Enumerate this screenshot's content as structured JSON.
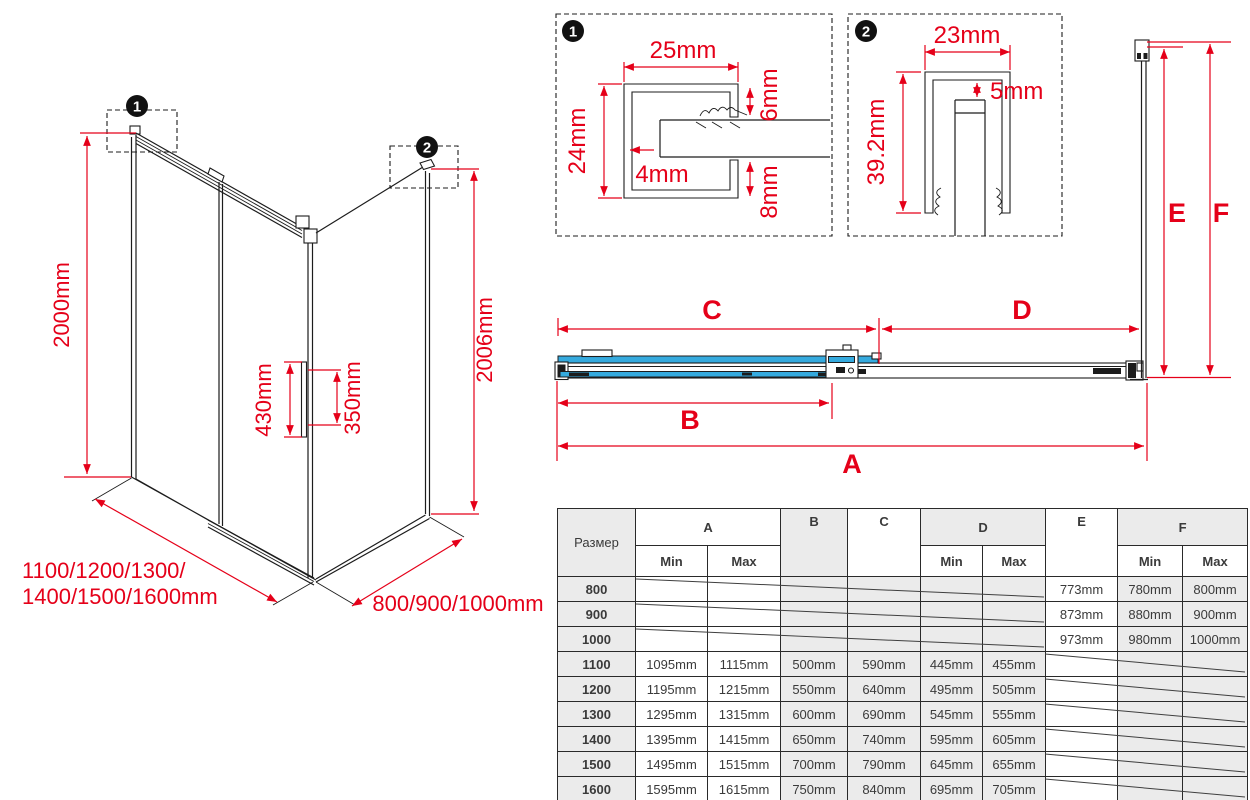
{
  "iso": {
    "marker1": "1",
    "marker2": "2",
    "height_left": "2000mm",
    "height_right": "2006mm",
    "handle_outer": "430mm",
    "handle_inner": "350mm",
    "front_widths_line1": "1100/1200/1300/",
    "front_widths_line2": "1400/1500/1600mm",
    "side_widths": "800/900/1000mm"
  },
  "detail1": {
    "marker": "1",
    "width": "25mm",
    "height": "24mm",
    "wall": "4mm",
    "top_arm": "6mm",
    "bottom_arm": "8mm"
  },
  "detail2": {
    "marker": "2",
    "width": "23mm",
    "gap": "5mm",
    "height": "39.2mm"
  },
  "plan": {
    "dim_a": "A",
    "dim_b": "B",
    "dim_c": "C",
    "dim_d": "D",
    "dim_e": "E",
    "dim_f": "F"
  },
  "table": {
    "size_header": "Размер",
    "col_a": "A",
    "col_b": "B",
    "col_c": "C",
    "col_d": "D",
    "col_e": "E",
    "col_f": "F",
    "min": "Min",
    "max": "Max",
    "rows": [
      {
        "size": "800",
        "a_min": "",
        "a_max": "",
        "b": "",
        "c": "",
        "d_min": "",
        "d_max": "",
        "e": "773mm",
        "f_min": "780mm",
        "f_max": "800mm"
      },
      {
        "size": "900",
        "a_min": "",
        "a_max": "",
        "b": "",
        "c": "",
        "d_min": "",
        "d_max": "",
        "e": "873mm",
        "f_min": "880mm",
        "f_max": "900mm"
      },
      {
        "size": "1000",
        "a_min": "",
        "a_max": "",
        "b": "",
        "c": "",
        "d_min": "",
        "d_max": "",
        "e": "973mm",
        "f_min": "980mm",
        "f_max": "1000mm"
      },
      {
        "size": "1100",
        "a_min": "1095mm",
        "a_max": "1115mm",
        "b": "500mm",
        "c": "590mm",
        "d_min": "445mm",
        "d_max": "455mm",
        "e": "",
        "f_min": "",
        "f_max": ""
      },
      {
        "size": "1200",
        "a_min": "1195mm",
        "a_max": "1215mm",
        "b": "550mm",
        "c": "640mm",
        "d_min": "495mm",
        "d_max": "505mm",
        "e": "",
        "f_min": "",
        "f_max": ""
      },
      {
        "size": "1300",
        "a_min": "1295mm",
        "a_max": "1315mm",
        "b": "600mm",
        "c": "690mm",
        "d_min": "545mm",
        "d_max": "555mm",
        "e": "",
        "f_min": "",
        "f_max": ""
      },
      {
        "size": "1400",
        "a_min": "1395mm",
        "a_max": "1415mm",
        "b": "650mm",
        "c": "740mm",
        "d_min": "595mm",
        "d_max": "605mm",
        "e": "",
        "f_min": "",
        "f_max": ""
      },
      {
        "size": "1500",
        "a_min": "1495mm",
        "a_max": "1515mm",
        "b": "700mm",
        "c": "790mm",
        "d_min": "645mm",
        "d_max": "655mm",
        "e": "",
        "f_min": "",
        "f_max": ""
      },
      {
        "size": "1600",
        "a_min": "1595mm",
        "a_max": "1615mm",
        "b": "750mm",
        "c": "840mm",
        "d_min": "695mm",
        "d_max": "705mm",
        "e": "",
        "f_min": "",
        "f_max": ""
      }
    ]
  }
}
